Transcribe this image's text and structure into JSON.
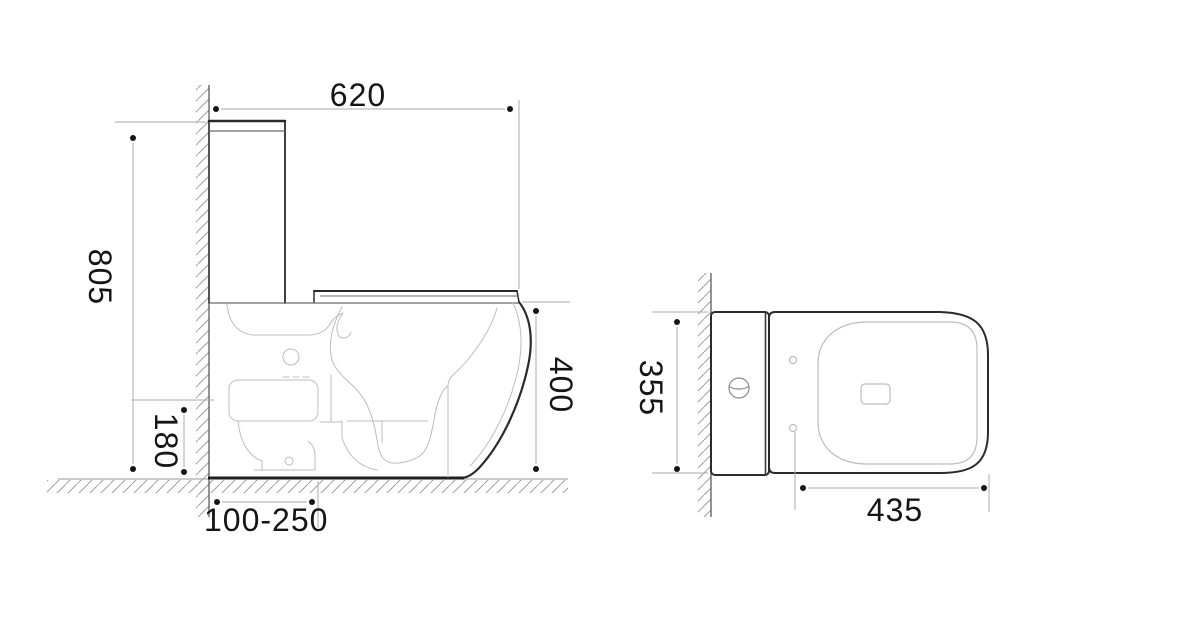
{
  "side_view": {
    "dimensions": {
      "width_top": "620",
      "height_overall": "805",
      "inlet_height": "180",
      "rim_height": "400",
      "rough_in": "100-250"
    }
  },
  "top_view": {
    "dimensions": {
      "width_overall": "355",
      "bowl_length": "435"
    }
  },
  "colors": {
    "background": "#ffffff",
    "outline": "#2b2b2b",
    "mid_line": "#6a6a6a",
    "detail_light": "#bdbdbd",
    "dimension_line": "#ababab",
    "wall_line": "#5a5a5a",
    "hatch": "#9f9f9f",
    "text": "#151515"
  }
}
